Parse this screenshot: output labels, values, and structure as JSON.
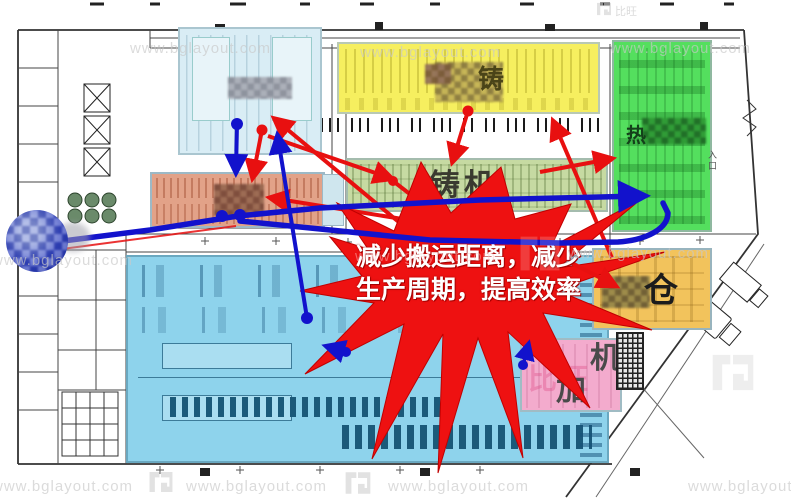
{
  "watermark": {
    "url": "www.bglayout.com",
    "brand": "比旺"
  },
  "callout": {
    "line1": "减少搬运距离，减少",
    "line2": "生产周期，提高效率"
  },
  "zones": {
    "die_cast": {
      "label": "铸"
    },
    "heat_treat": {
      "label": "热"
    },
    "cast_machines": {
      "label": "铸机"
    },
    "warehouse": {
      "label": "仓"
    },
    "machining": {
      "char1": "机",
      "char2": "加"
    }
  },
  "plan": {
    "entrance_label": "入口"
  },
  "colors": {
    "star_red": "#ee1111",
    "arrow_red": "#e81010",
    "arrow_blue": "#1212cc",
    "zone_yellow": "#f6ef5f",
    "zone_green": "#54df5e",
    "zone_green_band": "#c6daa2",
    "zone_salmon": "#e2a288",
    "zone_blue": "#8ed3ec",
    "zone_amber": "#f2c35c",
    "zone_pink": "#f3abcd",
    "zone_paleblue": "#d9edf5"
  }
}
